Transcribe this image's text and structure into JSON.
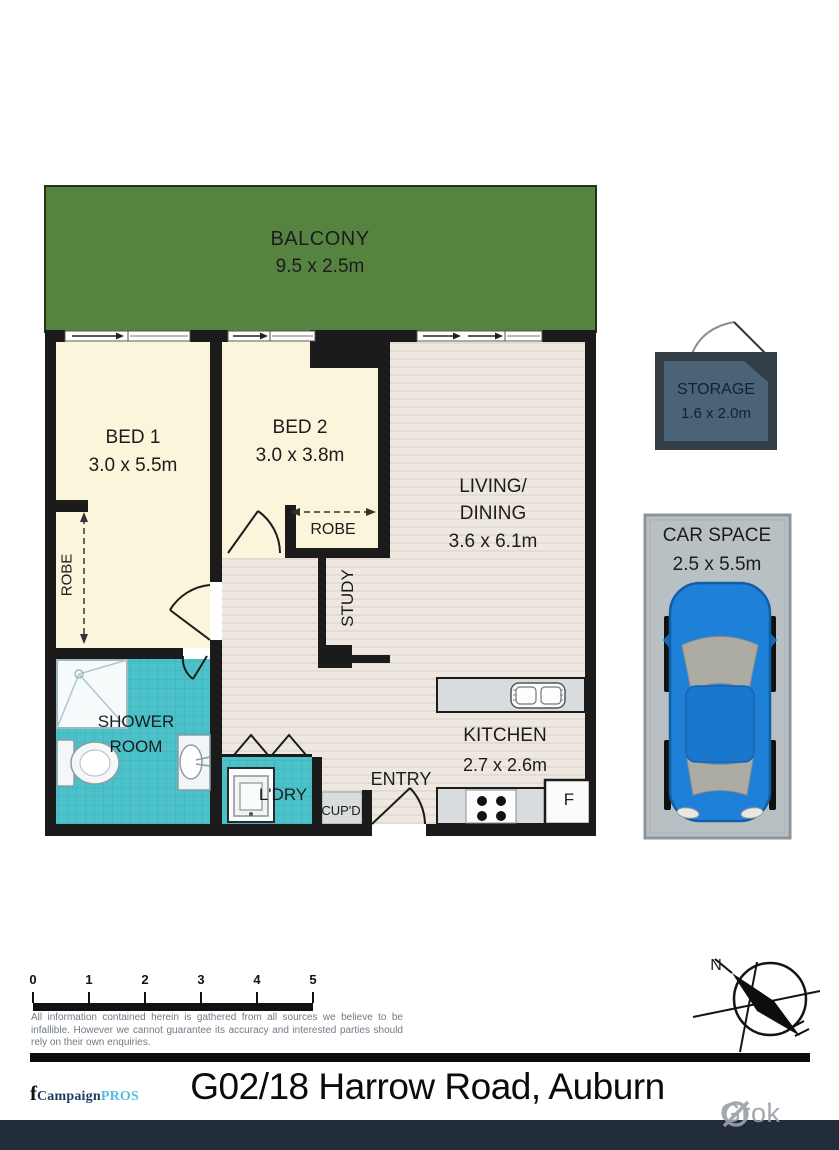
{
  "plan": {
    "balcony": {
      "name": "BALCONY",
      "dims": "9.5 x 2.5m"
    },
    "bed1": {
      "name": "BED 1",
      "dims": "3.0 x 5.5m"
    },
    "bed2": {
      "name": "BED 2",
      "dims": "3.0 x 3.8m"
    },
    "living": {
      "name1": "LIVING/",
      "name2": "DINING",
      "dims": "3.6 x 6.1m"
    },
    "kitchen": {
      "name": "KITCHEN",
      "dims": "2.7 x 2.6m"
    },
    "shower_room": {
      "name1": "SHOWER",
      "name2": "ROOM"
    },
    "study": {
      "name": "STUDY"
    },
    "robe_bed1": {
      "name": "ROBE"
    },
    "robe_bed2": {
      "name": "ROBE"
    },
    "laundry": {
      "name": "L'DRY"
    },
    "cupboard": {
      "name": "CUP'D"
    },
    "entry": {
      "name": "ENTRY"
    },
    "fridge": {
      "name": "F"
    },
    "storage": {
      "name": "STORAGE",
      "dims": "1.6 x 2.0m"
    },
    "car_space": {
      "name": "CAR SPACE",
      "dims": "2.5 x 5.5m"
    }
  },
  "scale_bar": {
    "ticks": [
      "0",
      "1",
      "2",
      "3",
      "4",
      "5"
    ]
  },
  "compass": {
    "north": "N"
  },
  "disclaimer": "All information contained herein is gathered from all sources we believe to be infallible. However we cannot guarantee its accuracy and interested parties should rely on their own enquiries.",
  "footer": {
    "logo": {
      "f": "f",
      "campaign": "Campaign",
      "pros": "PROS"
    },
    "title": "G02/18 Harrow Road, Auburn"
  },
  "watermark": {
    "brand": "Grok"
  },
  "colors": {
    "balcony_green": "#578340",
    "bedroom_cream": "#FBF6DB",
    "living_beige": "#EDE7DF",
    "wet_area_teal": "#4BC1C9",
    "wall_black": "#1B1B1B",
    "counter_grey": "#D8DCDE",
    "storage_slate": "#4A6377",
    "storage_border": "#333E46",
    "car_space_grey": "#B9C0C4",
    "car_blue": "#1F80D8",
    "footer_bar_navy": "#222C3A",
    "logo_navy": "#1E3A5F",
    "logo_blue": "#55BDE2"
  }
}
